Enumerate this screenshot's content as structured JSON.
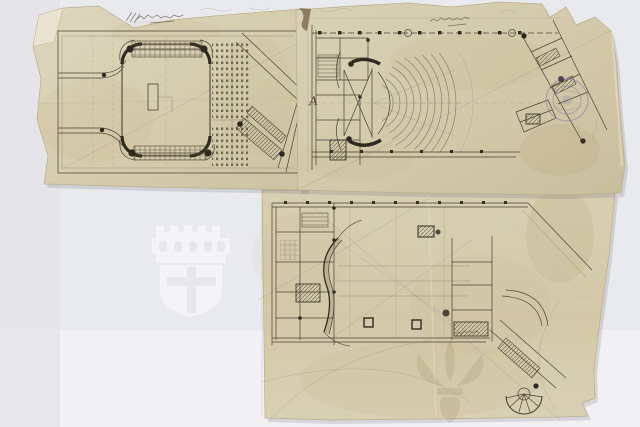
{
  "scene": {
    "description": "Photograph of three hand-drawn theatre floor plans in pencil and sepia ink on pieces of translucent tracing paper with torn edges, laid on a grey studio background",
    "background_color": "#e9eaee",
    "paper_color": "#d7ceb0",
    "ink_color": "#4c4234"
  },
  "plans": [
    {
      "id": "plan-upper-left",
      "description": "Stage-level plan: central rounded stage box with hatched machinery rows above and below, dotted seating grid at right and a diagonal stair wing"
    },
    {
      "id": "plan-upper-right",
      "description": "Auditorium plan: fan of concentric amphitheatre rows, stage shell at left, service rooms and an angled entrance wing with stairs at right"
    },
    {
      "id": "plan-lower",
      "description": "Upper-level plan: horseshoe balcony outline, service rooms at left, corridor rooms at right and an angled wing ending in a semicircular stair"
    }
  ],
  "annotations": {
    "letter": "A",
    "top_scribble": "illegible pencil numerals with three tally strokes",
    "bottom_scribble": "illegible pencil numerals"
  },
  "stamp": {
    "type": "circular ink stamp, text illegible",
    "color": "#8b7fae"
  },
  "watermarks": [
    {
      "position": "center-left",
      "style": "light castle-and-shield emblem on grey background",
      "color": "#ffffff"
    },
    {
      "position": "bottom-right",
      "style": "dark fleur emblem on tracing paper",
      "color": "#6d5626"
    }
  ]
}
